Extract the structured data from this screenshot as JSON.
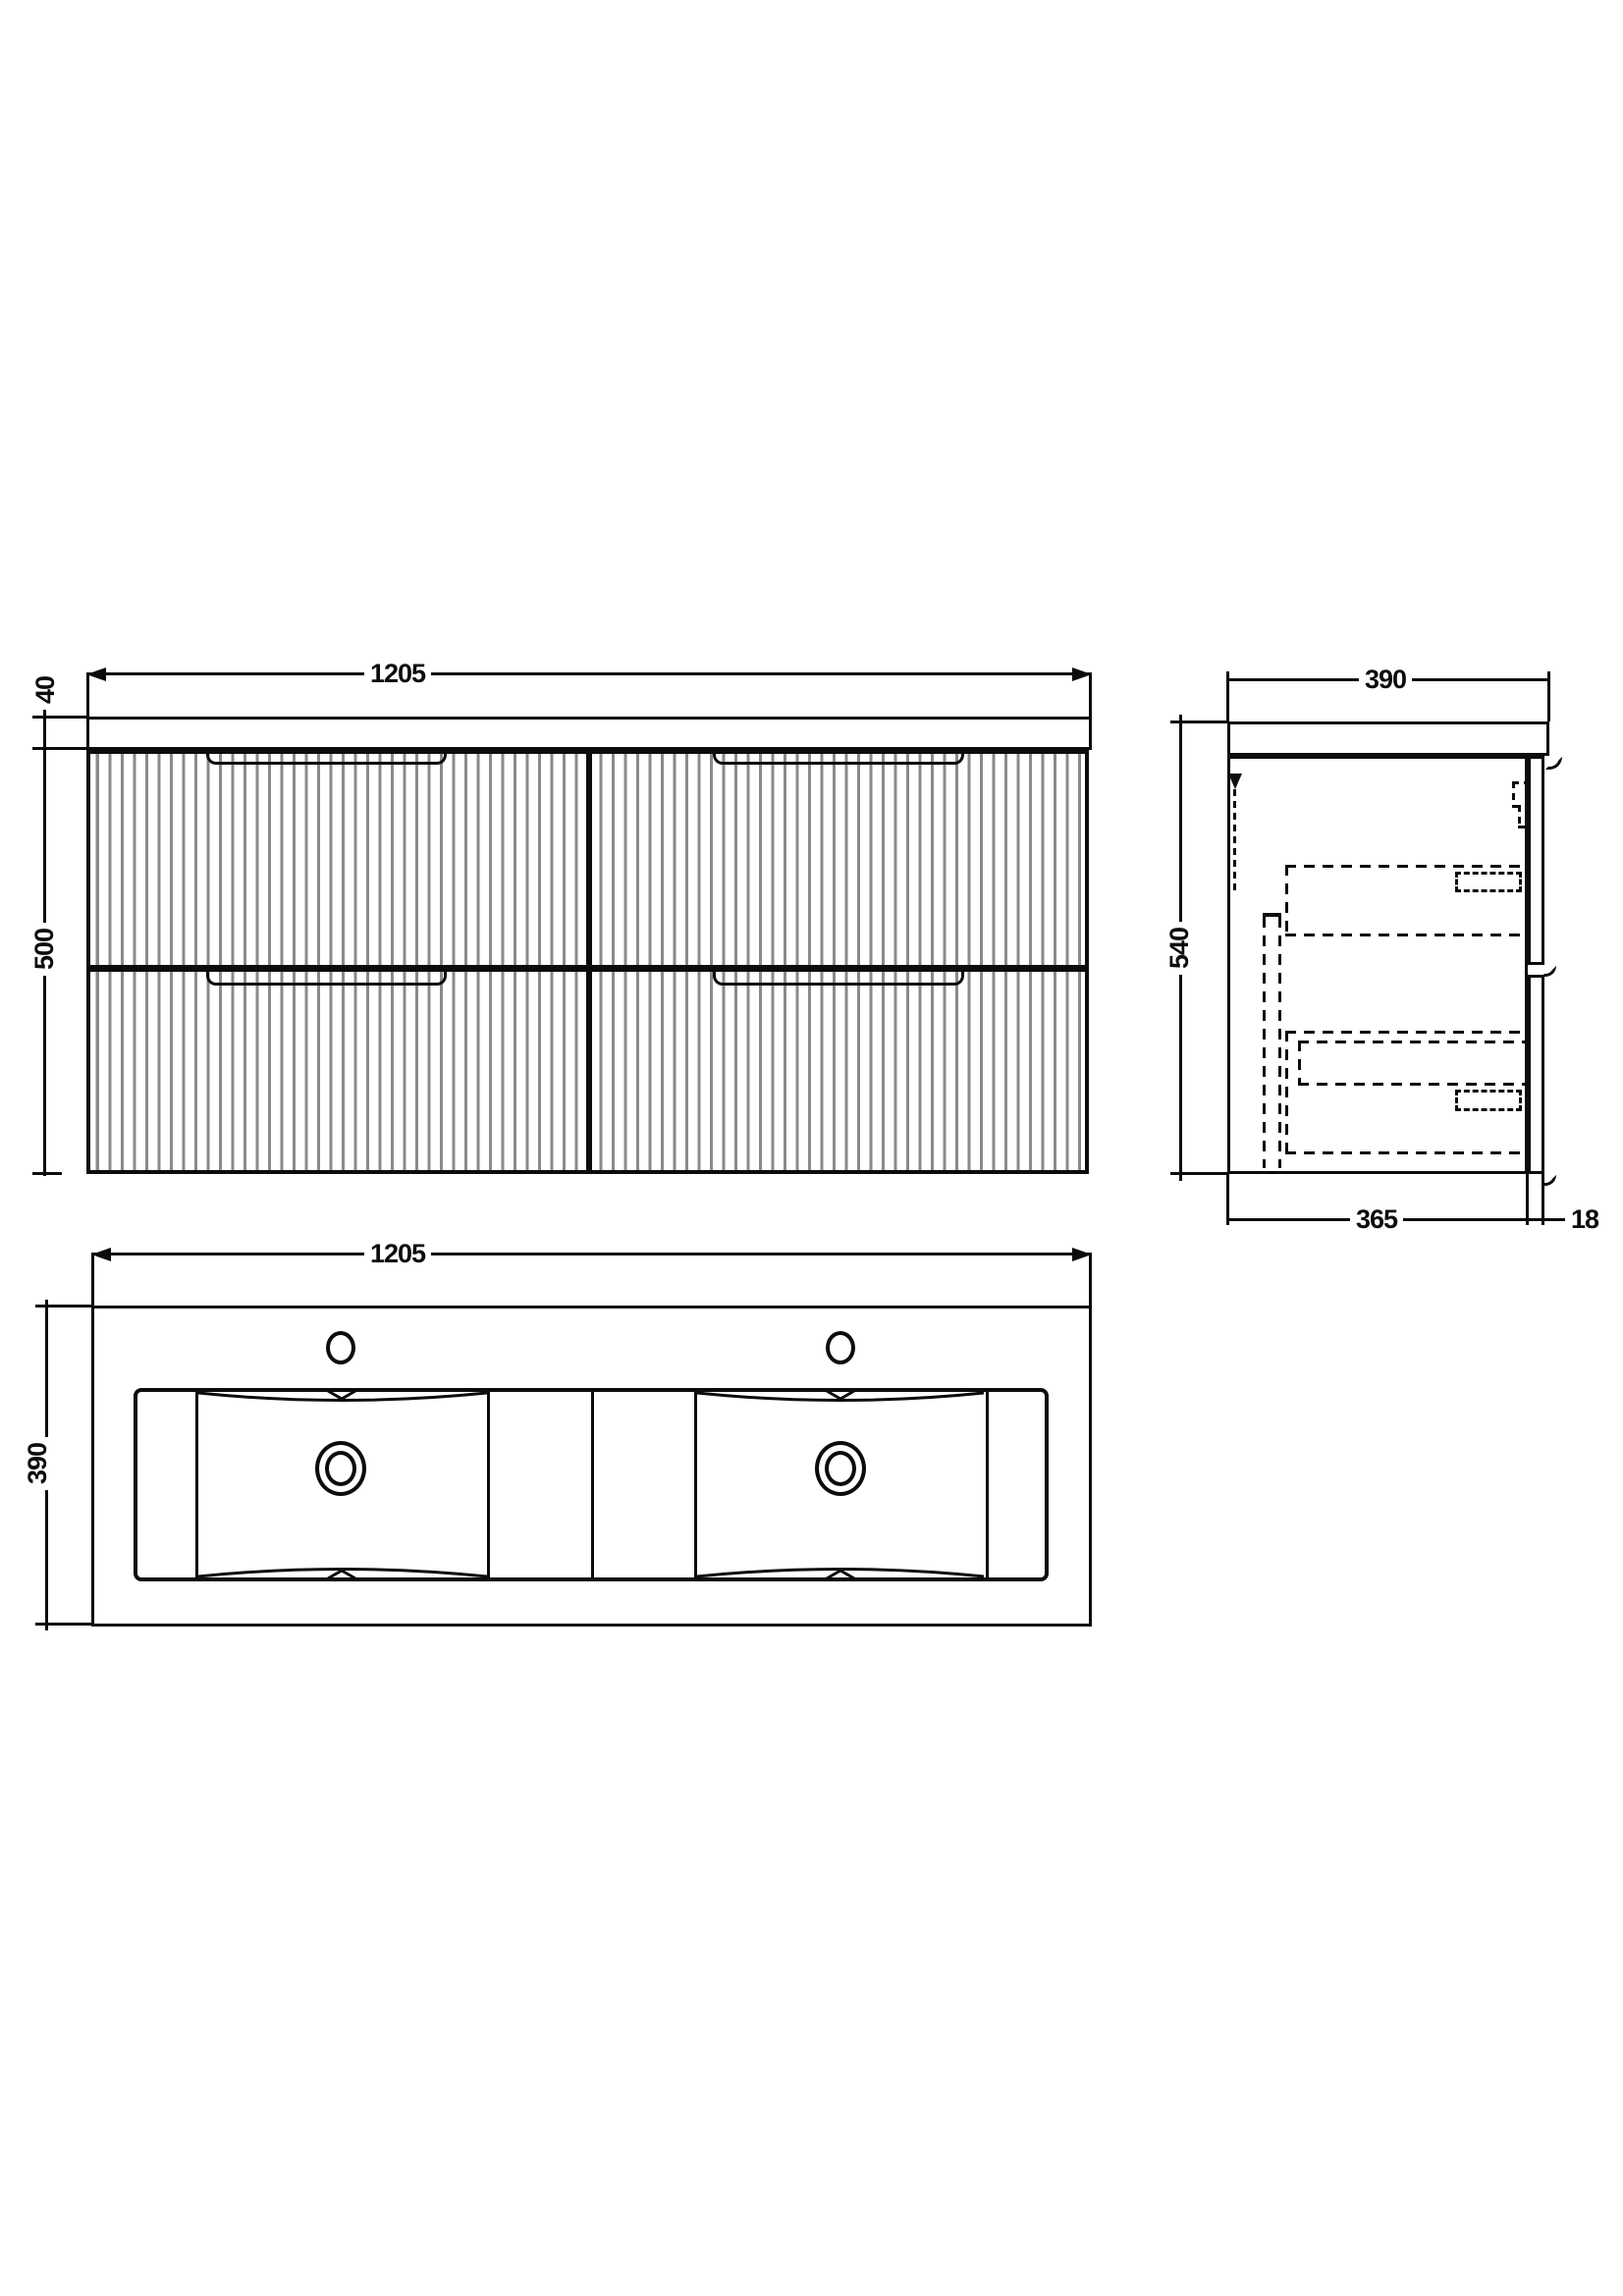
{
  "front_view": {
    "width_label": "1205",
    "countertop_thickness_label": "40",
    "cabinet_height_label": "500"
  },
  "side_view": {
    "depth_label": "390",
    "height_label": "540",
    "body_depth_label": "365",
    "drawer_front_thickness_label": "18"
  },
  "plan_view": {
    "width_label": "1205",
    "depth_label": "390"
  },
  "colors": {
    "ink": "#0c0c0c",
    "flute_line": "#8a8a8a",
    "background": "#ffffff"
  }
}
